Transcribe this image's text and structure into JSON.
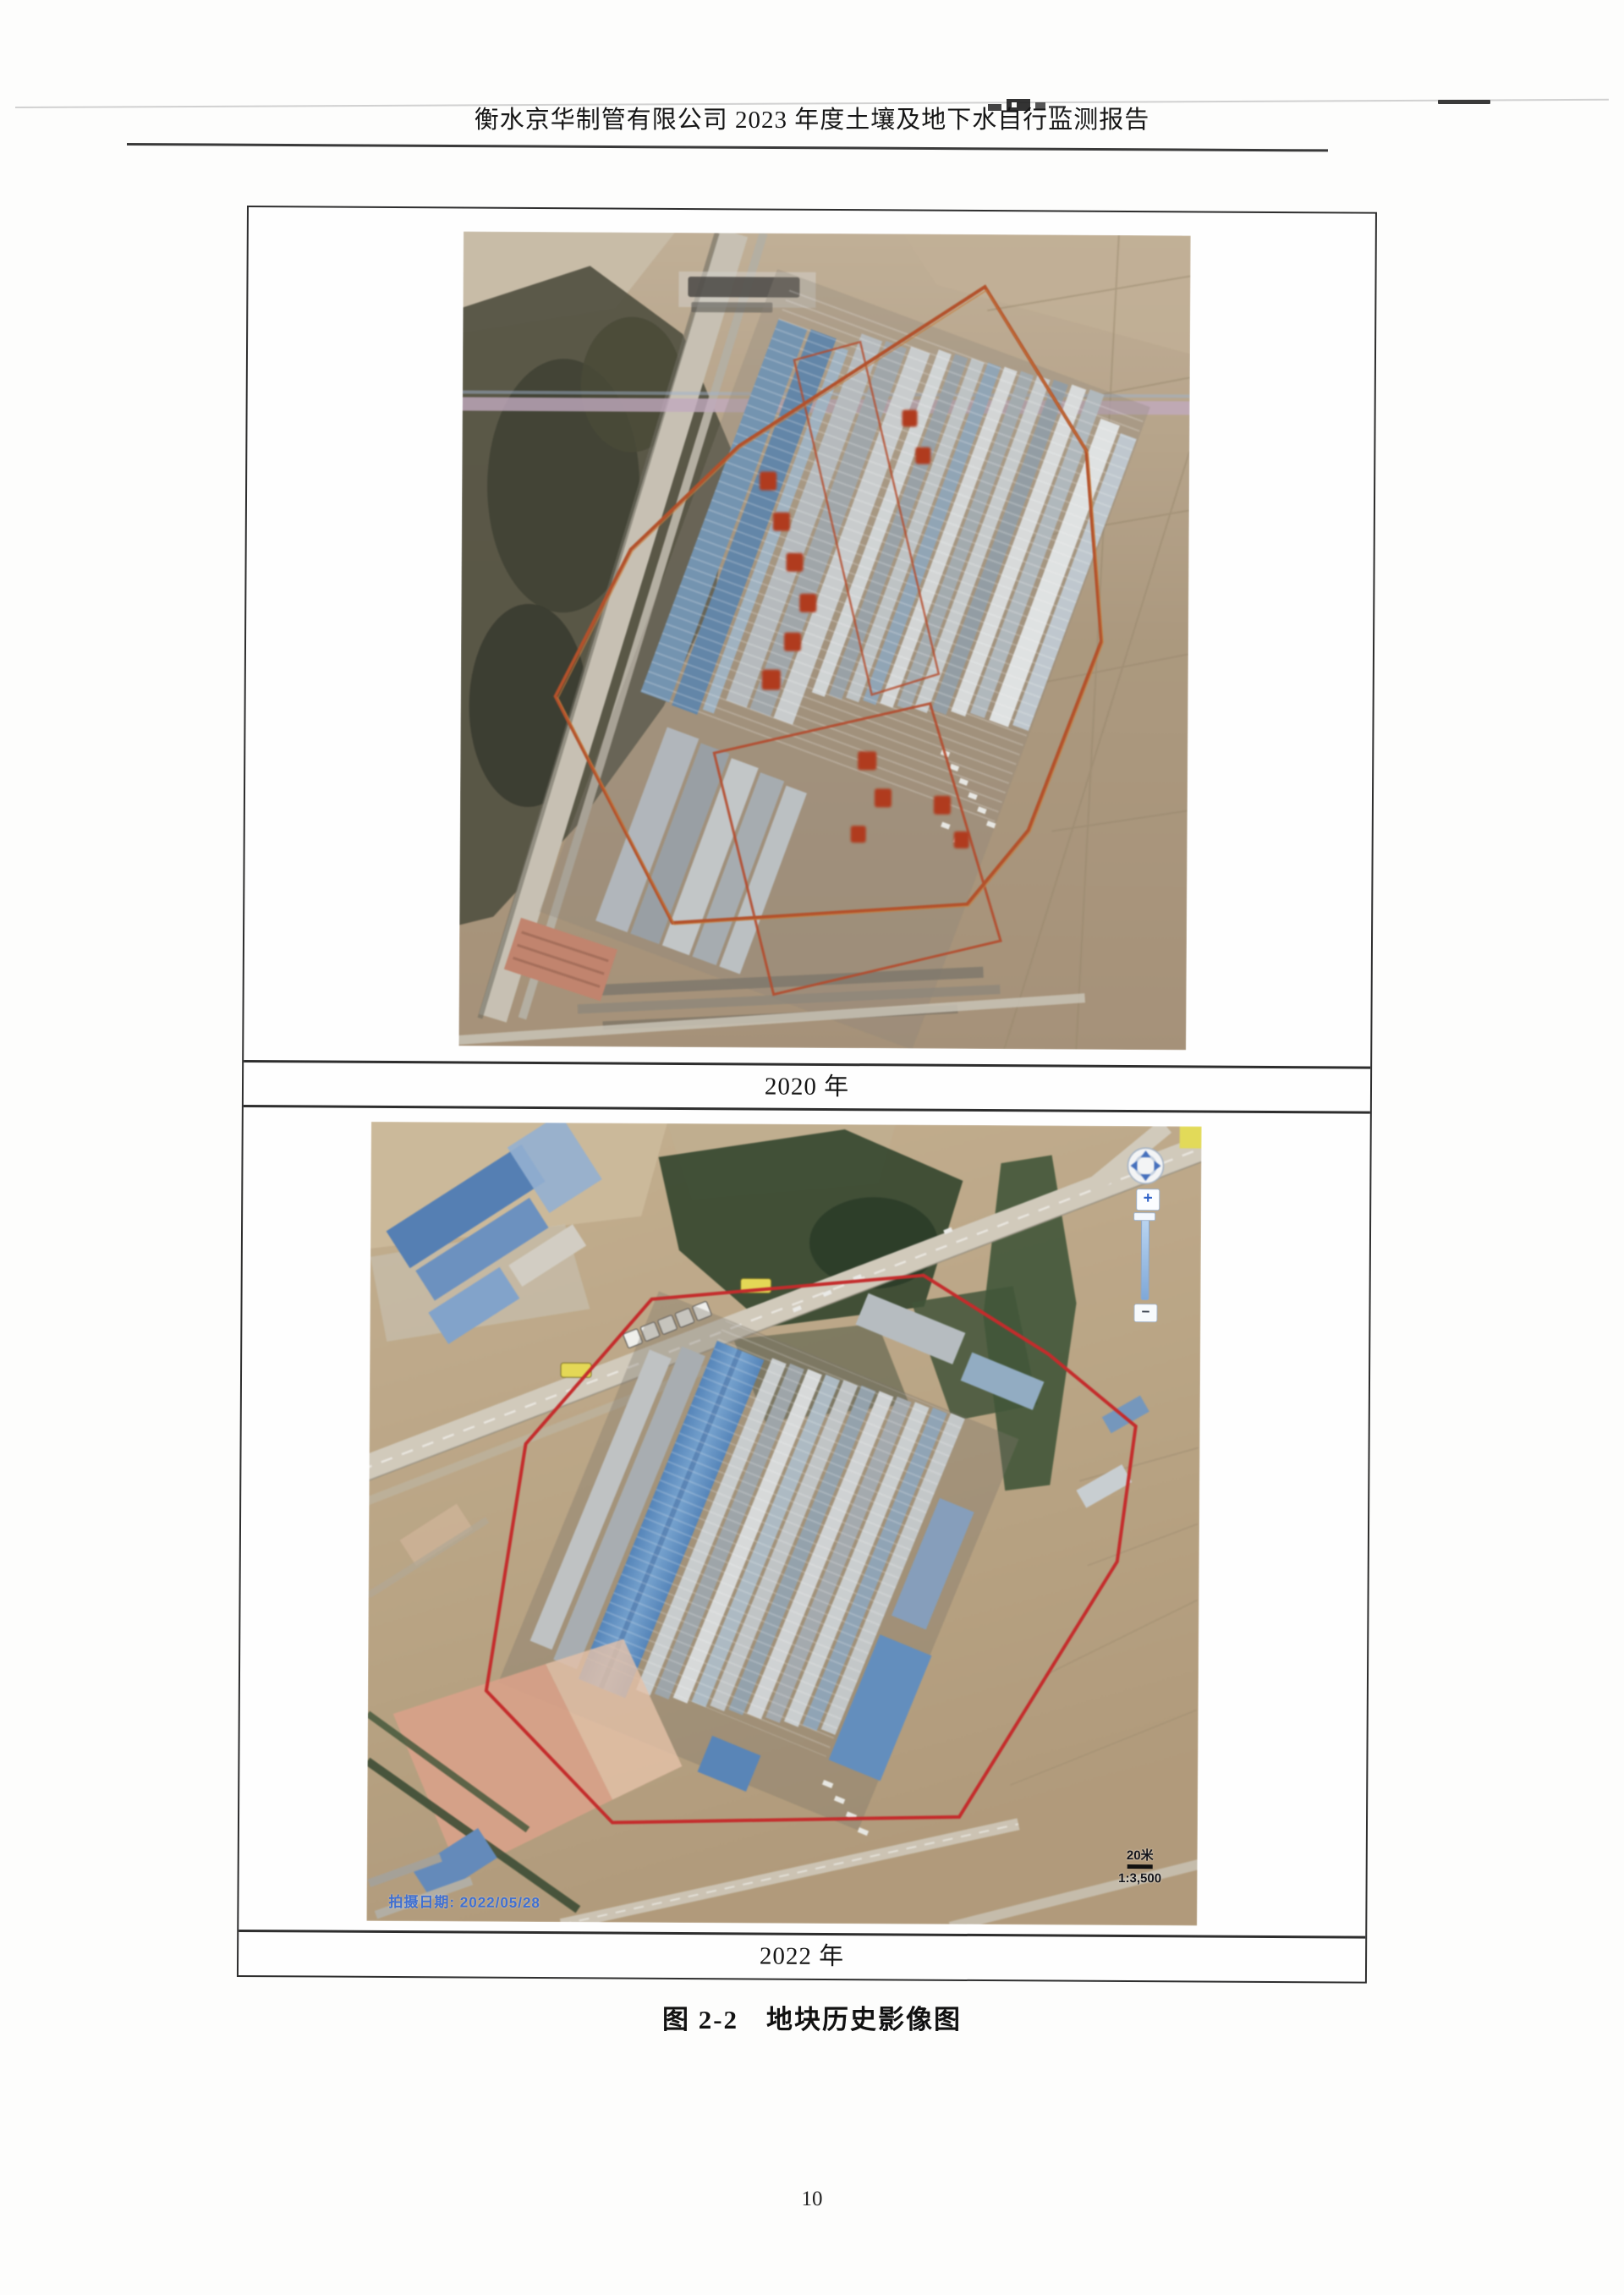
{
  "header": {
    "title": "衡水京华制管有限公司 2023 年度土壤及地下水自行监测报告"
  },
  "figure": {
    "caption_2020": "2020 年",
    "caption_2022": "2022 年",
    "title": "图 2-2　地块历史影像图"
  },
  "map_2022": {
    "imagery_date": "拍摄日期: 2022/05/28",
    "scale_distance": "20米",
    "scale_ratio": "1:3,500",
    "zoom_in": "+",
    "zoom_out": "−"
  },
  "footer": {
    "page_number": "10"
  },
  "colors": {
    "boundary_red_2020": "#c64a1a",
    "boundary_red_2022": "#e01f1f",
    "roof_blue": "#4f86c6",
    "farmland_tan": "#b59e7d",
    "vegetation_dark": "#3c4a2e",
    "date_text_blue": "#3f6fd1",
    "road_sign_yellow": "#efe03b"
  }
}
